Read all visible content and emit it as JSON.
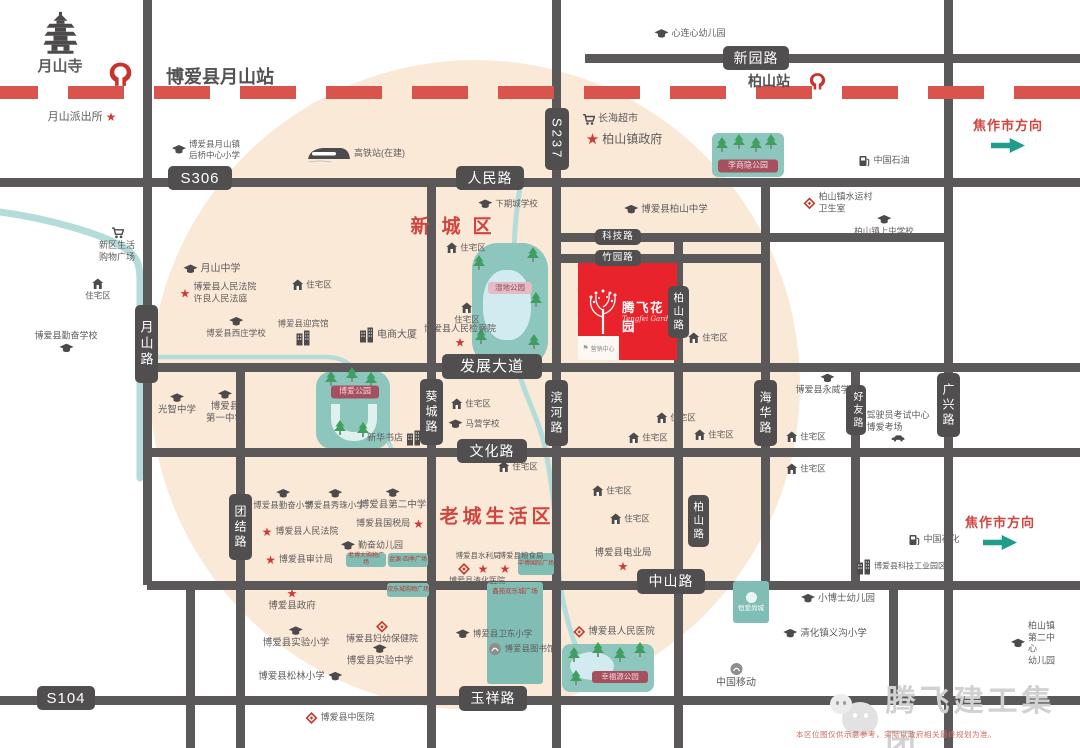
{
  "watermark": {
    "text": "腾飞建工集团"
  },
  "disclaimer": "本区位图仅供示意参考，实际以政府相关最终规划为准。",
  "project": {
    "name": "腾飞花园",
    "subtitle": "Tengfei Garden",
    "annex": "营销中心"
  },
  "areas": [
    {
      "label": "新城区",
      "x": 457,
      "y": 225,
      "fs": 19,
      "ls": 12
    },
    {
      "label": "老城生活区",
      "x": 497,
      "y": 515,
      "fs": 19,
      "ls": 4
    }
  ],
  "directions": [
    {
      "text": "焦作市方向",
      "x": 1008,
      "y": 134
    },
    {
      "text": "焦作市方向",
      "x": 1000,
      "y": 531
    }
  ],
  "railway": {
    "y": 86,
    "h": 13,
    "color": "#d9544d"
  },
  "stations": [
    {
      "name": "博爱县月山站",
      "logo_x": 120,
      "logo_y": 74,
      "logo_s": 27,
      "tx": 220,
      "ty": 76,
      "fs": 18
    },
    {
      "name": "柏山站",
      "logo_x": 817,
      "logo_y": 81,
      "logo_s": 19,
      "tx": 769,
      "ty": 81,
      "fs": 14
    }
  ],
  "roads": {
    "horizontal": [
      {
        "name": "xinyuan-road",
        "y": 58,
        "x1": 585,
        "x2": 1080
      },
      {
        "name": "renmin-road-s306",
        "y": 182,
        "x1": 0,
        "x2": 1080
      },
      {
        "name": "keji-road",
        "y": 237,
        "x1": 556,
        "x2": 948
      },
      {
        "name": "zhuyuan-road",
        "y": 258,
        "x1": 556,
        "x2": 765
      },
      {
        "name": "fazhan-avenue",
        "y": 367,
        "x1": 147,
        "x2": 1080
      },
      {
        "name": "wenhua-road",
        "y": 452,
        "x1": 147,
        "x2": 1080
      },
      {
        "name": "zhongshan-road",
        "y": 585,
        "x1": 147,
        "x2": 1080
      },
      {
        "name": "yuxiang-road-s104",
        "y": 700,
        "x1": 0,
        "x2": 1080
      }
    ],
    "vertical": [
      {
        "name": "yueshan-road",
        "x": 147,
        "y1": 0,
        "y2": 585
      },
      {
        "name": "west-south-road",
        "x": 190,
        "y1": 585,
        "y2": 748
      },
      {
        "name": "tuanjie-road",
        "x": 240,
        "y1": 367,
        "y2": 748
      },
      {
        "name": "kuicheng-road",
        "x": 431,
        "y1": 182,
        "y2": 748
      },
      {
        "name": "s237-binhe-road",
        "x": 556,
        "y1": 0,
        "y2": 748
      },
      {
        "name": "baishan-road",
        "x": 678,
        "y1": 237,
        "y2": 748
      },
      {
        "name": "haihua-road",
        "x": 765,
        "y1": 182,
        "y2": 585
      },
      {
        "name": "haoyou-road",
        "x": 855,
        "y1": 367,
        "y2": 585
      },
      {
        "name": "south-east-road",
        "x": 893,
        "y1": 585,
        "y2": 700
      },
      {
        "name": "guangxing-road",
        "x": 948,
        "y1": 0,
        "y2": 748
      }
    ]
  },
  "road_labels": [
    {
      "t": "S306",
      "x": 200,
      "y": 178,
      "w": 64,
      "h": 24,
      "fs": 15
    },
    {
      "t": "人民路",
      "x": 490,
      "y": 178,
      "w": 68,
      "h": 24,
      "fs": 14
    },
    {
      "t": "新园路",
      "x": 756,
      "y": 58,
      "w": 66,
      "h": 24,
      "fs": 14
    },
    {
      "t": "S237",
      "x": 557,
      "y": 139,
      "w": 24,
      "h": 62,
      "fs": 13,
      "v": 1
    },
    {
      "t": "科技路",
      "x": 618,
      "y": 237,
      "w": 46,
      "h": 16,
      "fs": 9.5
    },
    {
      "t": "竹园路",
      "x": 618,
      "y": 258,
      "w": 46,
      "h": 16,
      "fs": 9.5
    },
    {
      "t": "发展大道",
      "x": 492,
      "y": 366,
      "w": 100,
      "h": 25,
      "fs": 15
    },
    {
      "t": "文化路",
      "x": 492,
      "y": 451,
      "w": 70,
      "h": 24,
      "fs": 14
    },
    {
      "t": "中山路",
      "x": 671,
      "y": 581,
      "w": 68,
      "h": 25,
      "fs": 14
    },
    {
      "t": "玉祥路",
      "x": 493,
      "y": 698,
      "w": 68,
      "h": 25,
      "fs": 14
    },
    {
      "t": "S104",
      "x": 66,
      "y": 698,
      "w": 58,
      "h": 24,
      "fs": 15
    },
    {
      "t": "月山路",
      "x": 146,
      "y": 344,
      "w": 23,
      "h": 78,
      "fs": 13,
      "v": 1
    },
    {
      "t": "团结路",
      "x": 240,
      "y": 527,
      "w": 23,
      "h": 66,
      "fs": 12,
      "v": 1
    },
    {
      "t": "葵城路",
      "x": 431,
      "y": 412,
      "w": 23,
      "h": 66,
      "fs": 12,
      "v": 1
    },
    {
      "t": "滨河路",
      "x": 556,
      "y": 413,
      "w": 23,
      "h": 66,
      "fs": 12,
      "v": 1
    },
    {
      "t": "柏山路",
      "x": 678,
      "y": 312,
      "w": 21,
      "h": 52,
      "fs": 10.5,
      "v": 1
    },
    {
      "t": "柏山路",
      "x": 698,
      "y": 521,
      "w": 21,
      "h": 52,
      "fs": 10.5,
      "v": 1
    },
    {
      "t": "海华路",
      "x": 765,
      "y": 413,
      "w": 23,
      "h": 66,
      "fs": 12,
      "v": 1
    },
    {
      "t": "好友路",
      "x": 856,
      "y": 410,
      "w": 20,
      "h": 50,
      "fs": 10,
      "v": 1
    },
    {
      "t": "广兴路",
      "x": 948,
      "y": 405,
      "w": 23,
      "h": 64,
      "fs": 12,
      "v": 1
    }
  ],
  "rivers": [
    {
      "d": "M0,212 C45,218 100,233 123,247 C137,256 140,264 140,280 L140,478",
      "w": 7
    },
    {
      "d": "M141,357 L325,357 C350,357 356,370 366,392 C376,414 386,434 393,453",
      "w": 4.5
    },
    {
      "d": "M521,182 C517,205 515,222 514,250",
      "w": 5
    },
    {
      "d": "M516,362 C524,396 540,420 546,452 C552,484 556,516 557,548 C558,580 564,614 576,647",
      "w": 5
    }
  ],
  "parks": [
    {
      "id": "lishangyin",
      "x": 712,
      "y": 133,
      "w": 72,
      "h": 44,
      "r": 6,
      "trees": [
        [
          722,
          152
        ],
        [
          739,
          149
        ],
        [
          756,
          152
        ],
        [
          771,
          149
        ]
      ],
      "chip": {
        "t": "李商隐公园",
        "x": 748,
        "y": 166,
        "w": 60,
        "h": 13,
        "fs": 8,
        "variant": "maroon"
      }
    },
    {
      "id": "wetland",
      "x": 472,
      "y": 243,
      "w": 76,
      "h": 124,
      "r": 26,
      "pond": {
        "x": 483,
        "y": 270,
        "w": 48,
        "h": 70,
        "rr": "45%"
      },
      "trees": [
        [
          479,
          270
        ],
        [
          533,
          262
        ],
        [
          536,
          307
        ],
        [
          481,
          344
        ],
        [
          534,
          349
        ]
      ],
      "chip": {
        "t": "湿地公园",
        "x": 510,
        "y": 288,
        "w": 44,
        "h": 12,
        "fs": 7.5,
        "variant": "wet"
      }
    },
    {
      "id": "boai-park",
      "x": 316,
      "y": 371,
      "w": 74,
      "h": 78,
      "r": 16,
      "pondU": {
        "x": 331,
        "y": 404,
        "w": 28,
        "h": 28
      },
      "trees": [
        [
          331,
          386
        ],
        [
          352,
          382
        ],
        [
          371,
          387
        ],
        [
          340,
          435
        ],
        [
          363,
          437
        ]
      ],
      "chip": {
        "t": "博爱公园",
        "x": 355,
        "y": 392,
        "w": 48,
        "h": 13,
        "fs": 8,
        "variant": "maroon"
      }
    },
    {
      "id": "xingfuyuan",
      "x": 562,
      "y": 644,
      "w": 92,
      "h": 48,
      "r": 8,
      "pond": {
        "x": 570,
        "y": 652,
        "w": 44,
        "h": 28,
        "rr": "50%"
      },
      "trees": [
        [
          574,
          662
        ],
        [
          598,
          657
        ],
        [
          620,
          662
        ],
        [
          640,
          657
        ],
        [
          576,
          685
        ]
      ],
      "chip": {
        "t": "幸福源公园",
        "x": 620,
        "y": 677,
        "w": 56,
        "h": 12,
        "fs": 7.5,
        "variant": "maroon"
      }
    }
  ],
  "retail_blocks": [
    {
      "t": "老博大购物广场",
      "x": 366,
      "y": 560,
      "w": 40,
      "h": 14,
      "fs": 6,
      "variant": "retail"
    },
    {
      "t": "金源·四季广场",
      "x": 408,
      "y": 560,
      "w": 40,
      "h": 14,
      "fs": 6,
      "variant": "retail"
    },
    {
      "t": "中博国际广场",
      "x": 536,
      "y": 564,
      "w": 36,
      "h": 22,
      "fs": 6,
      "variant": "retail"
    },
    {
      "t": "欢乐城购物广场",
      "x": 408,
      "y": 590,
      "w": 42,
      "h": 14,
      "fs": 6,
      "variant": "retail"
    },
    {
      "t": "鑫苑欢乐城广场",
      "x": 515,
      "y": 633,
      "w": 56,
      "h": 96,
      "fs": 6.5,
      "variant": "retail tall"
    },
    {
      "t": "恒爱尚城",
      "x": 751,
      "y": 602,
      "w": 36,
      "h": 42,
      "fs": 6.5,
      "variant": "estate"
    }
  ],
  "pois": [
    {
      "t": "月山寺",
      "i": "pagoda",
      "ip": "t",
      "x": 60,
      "y": 44,
      "fs": 15,
      "b": 1
    },
    {
      "t": "月山派出所",
      "i": "star",
      "ip": "r",
      "x": 82,
      "y": 117,
      "fs": 11
    },
    {
      "t": "博爱县月山镇\n后桥中心小学",
      "i": "cap",
      "ip": "l",
      "x": 206,
      "y": 150,
      "fs": 8.5
    },
    {
      "t": "高铁站(在建)",
      "i": "train",
      "ip": "l",
      "x": 356,
      "y": 154,
      "fs": 9
    },
    {
      "t": "长海超市",
      "i": "cart",
      "ip": "l",
      "x": 610,
      "y": 119,
      "fs": 10
    },
    {
      "t": "柏山镇政府",
      "i": "star",
      "ip": "l",
      "x": 624,
      "y": 140,
      "fs": 12,
      "sb": 1
    },
    {
      "t": "心连心幼儿园",
      "i": "cap",
      "ip": "l",
      "x": 690,
      "y": 34,
      "fs": 9
    },
    {
      "t": "中国石油",
      "i": "gas",
      "ip": "l",
      "x": 884,
      "y": 161,
      "fs": 9
    },
    {
      "t": "柏山镇水运村\n卫生室",
      "i": "diamond",
      "ip": "l",
      "x": 838,
      "y": 203,
      "fs": 9,
      "ta": "l"
    },
    {
      "t": "柏山镇上屯学校",
      "i": "cap",
      "ip": "t",
      "x": 884,
      "y": 226,
      "fs": 8.5
    },
    {
      "t": "博爱县柏山中学",
      "i": "cap",
      "ip": "l",
      "x": 666,
      "y": 210,
      "fs": 9.5
    },
    {
      "t": "下期城学校",
      "i": "cap",
      "ip": "l",
      "x": 508,
      "y": 204,
      "fs": 8.5
    },
    {
      "t": "住宅区",
      "i": "house",
      "ip": "l",
      "x": 466,
      "y": 248,
      "fs": 8.5
    },
    {
      "t": "月山中学",
      "i": "cap",
      "ip": "l",
      "x": 212,
      "y": 269,
      "fs": 10
    },
    {
      "t": "博爱县人民法院\n许良人民法庭",
      "i": "star",
      "ip": "l",
      "x": 218,
      "y": 293,
      "fs": 9,
      "ta": "l"
    },
    {
      "t": "新区生活\n购物广场",
      "i": "cart",
      "ip": "t",
      "x": 117,
      "y": 245,
      "fs": 9
    },
    {
      "t": "住宅区",
      "i": "house",
      "ip": "t",
      "x": 98,
      "y": 290,
      "fs": 8.5
    },
    {
      "t": "博爱县勤奋学校",
      "i": "cap",
      "ip": "b",
      "x": 66,
      "y": 342,
      "fs": 9
    },
    {
      "t": "博爱县西庄学校",
      "i": "cap",
      "ip": "t",
      "x": 236,
      "y": 328,
      "fs": 8.5
    },
    {
      "t": "博爱县迎宾馆",
      "i": "building",
      "ip": "b",
      "x": 303,
      "y": 332,
      "fs": 8.5
    },
    {
      "t": "电商大厦",
      "i": "building",
      "ip": "l",
      "x": 388,
      "y": 335,
      "fs": 10
    },
    {
      "t": "住宅区",
      "i": "house",
      "ip": "t",
      "x": 467,
      "y": 314,
      "fs": 8.5
    },
    {
      "t": "博爱县人民检察院",
      "i": "star",
      "ip": "b",
      "x": 460,
      "y": 336,
      "fs": 9
    },
    {
      "t": "住宅区",
      "i": "house",
      "ip": "l",
      "x": 312,
      "y": 285,
      "fs": 8.5
    },
    {
      "t": "住宅区",
      "i": "house",
      "ip": "l",
      "x": 708,
      "y": 338,
      "fs": 8.5
    },
    {
      "t": "新华书店",
      "i": "building",
      "ip": "r",
      "x": 394,
      "y": 438,
      "fs": 9
    },
    {
      "t": "光智中学",
      "i": "cap",
      "ip": "t",
      "x": 177,
      "y": 405,
      "fs": 9.5
    },
    {
      "t": "博爱县\n第一中学",
      "i": "cap",
      "ip": "t",
      "x": 225,
      "y": 408,
      "fs": 9.5
    },
    {
      "t": "马营学校",
      "i": "cap",
      "ip": "l",
      "x": 474,
      "y": 424,
      "fs": 8.5
    },
    {
      "t": "住宅区",
      "i": "house",
      "ip": "l",
      "x": 471,
      "y": 404,
      "fs": 8.5
    },
    {
      "t": "住宅区",
      "i": "house",
      "ip": "l",
      "x": 676,
      "y": 418,
      "fs": 8.5
    },
    {
      "t": "住宅区",
      "i": "house",
      "ip": "l",
      "x": 648,
      "y": 438,
      "fs": 8.5
    },
    {
      "t": "住宅区",
      "i": "house",
      "ip": "l",
      "x": 714,
      "y": 435,
      "fs": 8.5
    },
    {
      "t": "博爱县永威学校",
      "i": "cap",
      "ip": "t",
      "x": 827,
      "y": 385,
      "fs": 9
    },
    {
      "t": "驾驶员考试中心\n博爱考场",
      "i": "car",
      "ip": "b",
      "x": 898,
      "y": 426,
      "fs": 9,
      "ta": "l"
    },
    {
      "t": "住宅区",
      "i": "house",
      "ip": "l",
      "x": 806,
      "y": 437,
      "fs": 8.5
    },
    {
      "t": "住宅区",
      "i": "house",
      "ip": "l",
      "x": 806,
      "y": 469,
      "fs": 8.5
    },
    {
      "t": "住宅区",
      "i": "house",
      "ip": "l",
      "x": 518,
      "y": 467,
      "fs": 8.5
    },
    {
      "t": "住宅区",
      "i": "house",
      "ip": "l",
      "x": 612,
      "y": 491,
      "fs": 8.5
    },
    {
      "t": "住宅区",
      "i": "house",
      "ip": "l",
      "x": 630,
      "y": 519,
      "fs": 8.5
    },
    {
      "t": "博爱县勤奋小学",
      "i": "cap",
      "ip": "t",
      "x": 283,
      "y": 500,
      "fs": 8.5
    },
    {
      "t": "博爱县秀珠小学",
      "i": "cap",
      "ip": "t",
      "x": 335,
      "y": 500,
      "fs": 8.5
    },
    {
      "t": "博爱县第二中学",
      "i": "cap",
      "ip": "t",
      "x": 393,
      "y": 500,
      "fs": 9.5
    },
    {
      "t": "博爱县国税局",
      "i": "star",
      "ip": "r",
      "x": 390,
      "y": 524,
      "fs": 9
    },
    {
      "t": "博爱县人民法院",
      "i": "star",
      "ip": "l",
      "x": 300,
      "y": 532,
      "fs": 9
    },
    {
      "t": "勤奋幼儿园",
      "i": "cap",
      "ip": "l",
      "x": 372,
      "y": 546,
      "fs": 9
    },
    {
      "t": "博爱县审计局",
      "i": "star",
      "ip": "l",
      "x": 299,
      "y": 560,
      "fs": 9
    },
    {
      "t": "博爱县水利局",
      "i": "none",
      "x": 478,
      "y": 556,
      "fs": 7.5
    },
    {
      "t": "博爱县粮食局",
      "i": "none",
      "x": 521,
      "y": 556,
      "fs": 7.5
    },
    {
      "t": "",
      "i": "diamond",
      "x": 464,
      "y": 569
    },
    {
      "t": "",
      "i": "star",
      "x": 483,
      "y": 569
    },
    {
      "t": "",
      "i": "star",
      "x": 505,
      "y": 569
    },
    {
      "t": "博爱县清化医院",
      "i": "none",
      "x": 477,
      "y": 581,
      "fs": 8
    },
    {
      "t": "博爱县电业局",
      "i": "star",
      "ip": "b",
      "x": 623,
      "y": 560,
      "fs": 9.5
    },
    {
      "t": "博爱县科技工业园区",
      "i": "building",
      "ip": "l",
      "x": 901,
      "y": 567,
      "fs": 8
    },
    {
      "t": "博爱县政府",
      "i": "star",
      "ip": "t",
      "x": 292,
      "y": 600,
      "fs": 9.5
    },
    {
      "t": "博爱县实验小学",
      "i": "cap",
      "ip": "t",
      "x": 296,
      "y": 638,
      "fs": 9.5
    },
    {
      "t": "博爱县妇幼保健院",
      "i": "diamond",
      "ip": "t",
      "x": 382,
      "y": 633,
      "fs": 9
    },
    {
      "t": "博爱县实验中学",
      "i": "cap",
      "ip": "t",
      "x": 380,
      "y": 656,
      "fs": 9.5
    },
    {
      "t": "博爱县松林小学",
      "i": "cap",
      "ip": "r",
      "x": 300,
      "y": 677,
      "fs": 9.5
    },
    {
      "t": "博爱县卫东小学",
      "i": "cap",
      "ip": "l",
      "x": 494,
      "y": 634,
      "fs": 8.5
    },
    {
      "t": "博爱县图书馆",
      "i": "telecom",
      "ip": "l",
      "x": 522,
      "y": 649,
      "fs": 8.5
    },
    {
      "t": "小博士幼儿园",
      "i": "cap",
      "ip": "l",
      "x": 838,
      "y": 599,
      "fs": 9.5
    },
    {
      "t": "清化镇义沟小学",
      "i": "cap",
      "ip": "l",
      "x": 825,
      "y": 634,
      "fs": 9.5
    },
    {
      "t": "中国移动",
      "i": "telecom",
      "ip": "t",
      "x": 736,
      "y": 676,
      "fs": 10
    },
    {
      "t": "柏山镇第二中心\n幼儿园",
      "i": "cap",
      "ip": "l",
      "x": 1034,
      "y": 644,
      "fs": 9,
      "ta": "l"
    },
    {
      "t": "中国石化",
      "i": "gas",
      "ip": "l",
      "x": 934,
      "y": 540,
      "fs": 9
    },
    {
      "t": "博爱县人民医院",
      "i": "diamond",
      "ip": "l",
      "x": 614,
      "y": 632,
      "fs": 9.5
    },
    {
      "t": "博爱县中医院",
      "i": "diamond",
      "ip": "l",
      "x": 340,
      "y": 718,
      "fs": 9
    }
  ]
}
